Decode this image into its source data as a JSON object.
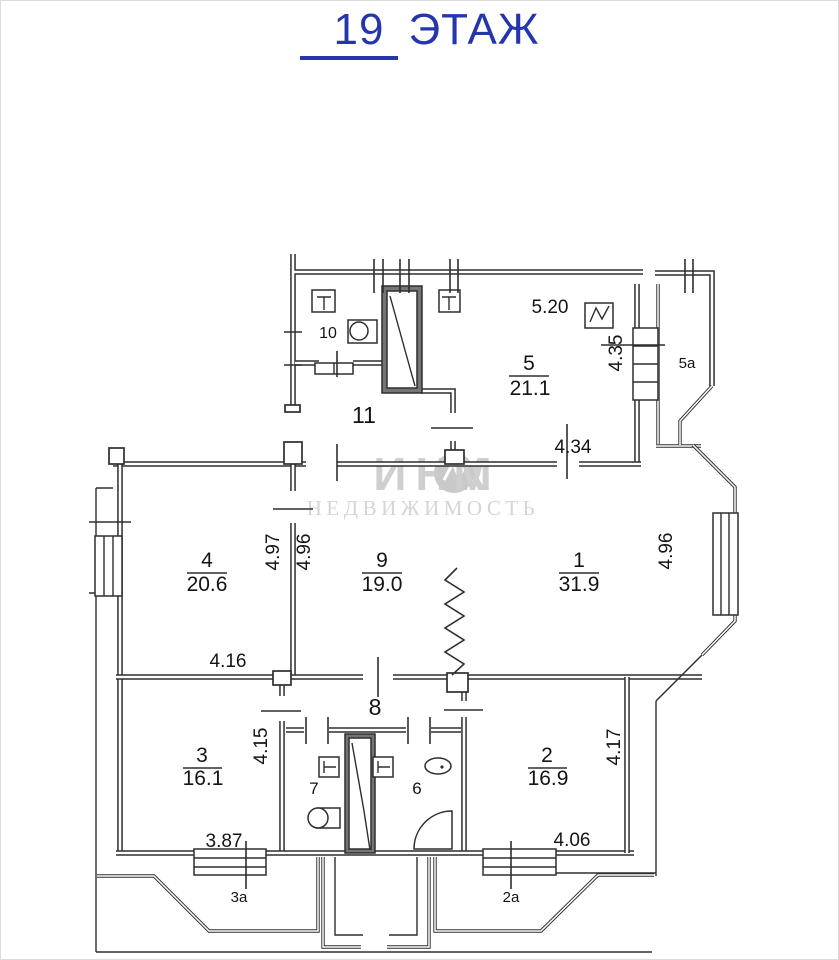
{
  "title": {
    "number": "19",
    "word": "ЭТАЖ"
  },
  "watermark": {
    "brand_left": "ИНК",
    "brand_right": "М",
    "sub": "НЕДВИЖИМОСТЬ"
  },
  "rooms": {
    "r1": {
      "number": "1",
      "area": "31.9"
    },
    "r2": {
      "number": "2",
      "area": "16.9"
    },
    "r3": {
      "number": "3",
      "area": "16.1"
    },
    "r4": {
      "number": "4",
      "area": "20.6"
    },
    "r5": {
      "number": "5",
      "area": "21.1"
    },
    "r9": {
      "number": "9",
      "area": "19.0"
    },
    "r6": {
      "number": "6"
    },
    "r7": {
      "number": "7"
    },
    "r8": {
      "number": "8"
    },
    "r10": {
      "number": "10"
    },
    "r11": {
      "number": "11"
    },
    "b5a": {
      "number": "5а"
    },
    "b3a": {
      "number": "3а"
    },
    "b2a": {
      "number": "2а"
    }
  },
  "dimensions": {
    "d520": "5.20",
    "d435": "4.35",
    "d434": "4.34",
    "d497": "4.97",
    "d496a": "4.96",
    "d496b": "4.96",
    "d416": "4.16",
    "d415": "4.15",
    "d417": "4.17",
    "d387": "3.87",
    "d406": "4.06"
  },
  "colors": {
    "title_blue": "#2536ac",
    "line": "#2e2e2e",
    "watermark_gray": "#cfcfcf",
    "shaft_fill": "#757575"
  }
}
